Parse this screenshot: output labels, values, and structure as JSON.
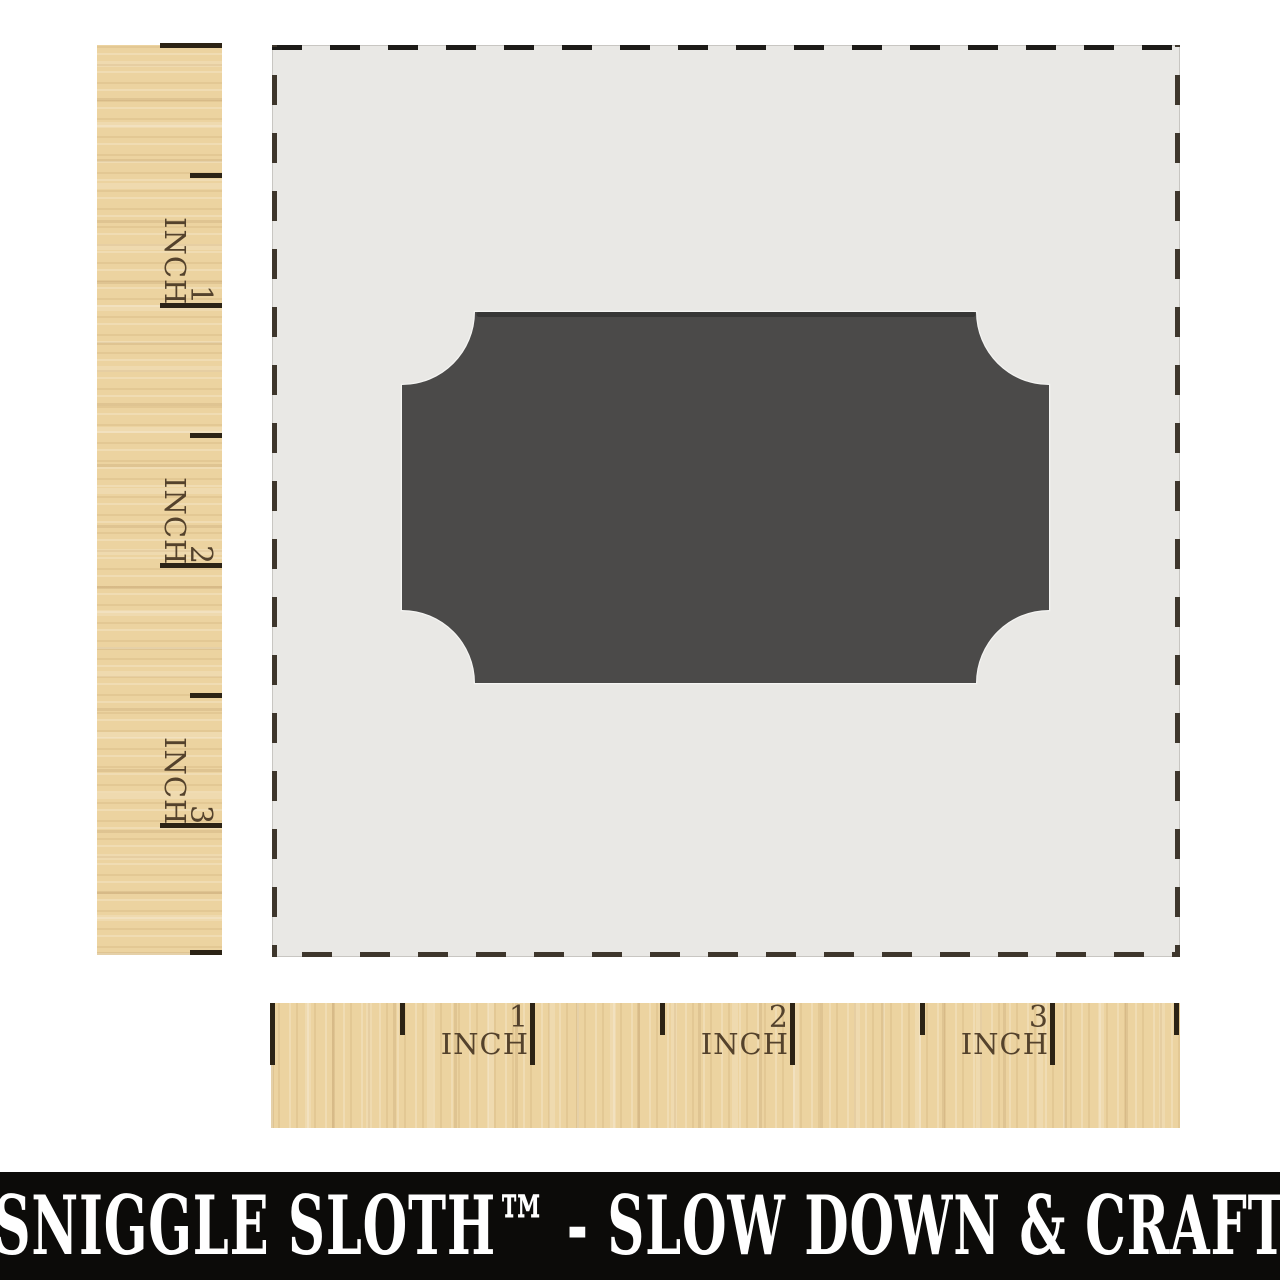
{
  "rulers": {
    "unit_label": "INCH",
    "vertical": {
      "numbers": [
        "1",
        "2",
        "3"
      ]
    },
    "horizontal": {
      "numbers": [
        "1",
        "2",
        "3"
      ]
    }
  },
  "footer": {
    "brand_text": "SNIGGLE SLOTH™ - SLOW DOWN & CRAFT"
  },
  "colors": {
    "background": "#ffffff",
    "wood": "#ecd3a0",
    "stencil_material": "#e9e8e5",
    "cutout_dark": "#4b4a49",
    "ruler_marking": "#54422c",
    "tick": "#2c2315",
    "dashed_border_top": "#1d1b18",
    "dashed_border_side": "#3e362c",
    "banner_background": "#0c0b09",
    "banner_text": "#ffffff"
  }
}
